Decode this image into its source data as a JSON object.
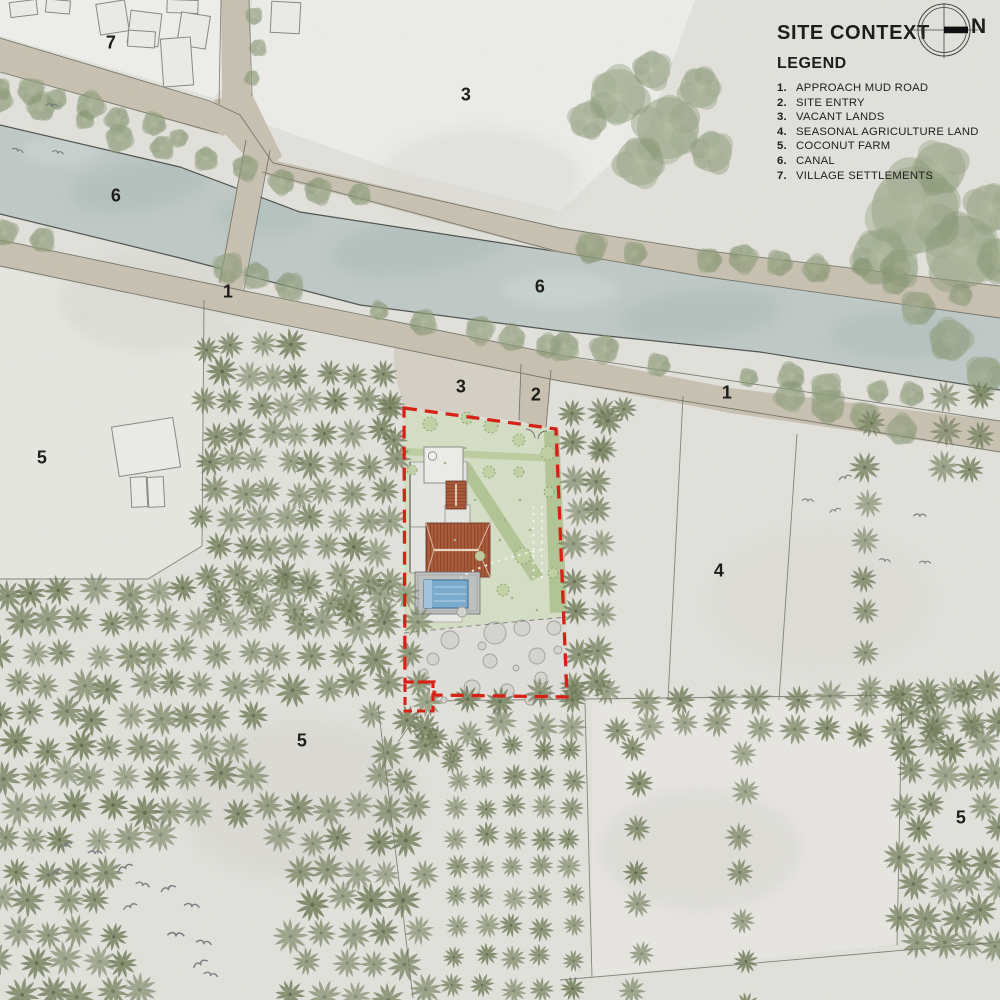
{
  "title_block": {
    "title": "SITE CONTEXT",
    "north_label": "N",
    "legend_heading": "LEGEND",
    "legend_items": [
      {
        "num": "1.",
        "label": "APPROACH MUD ROAD"
      },
      {
        "num": "2.",
        "label": "SITE ENTRY"
      },
      {
        "num": "3.",
        "label": "VACANT LANDS"
      },
      {
        "num": "4.",
        "label": "SEASONAL AGRICULTURE LAND"
      },
      {
        "num": "5.",
        "label": "COCONUT FARM"
      },
      {
        "num": "6.",
        "label": "CANAL"
      },
      {
        "num": "7.",
        "label": "VILLAGE SETTLEMENTS"
      }
    ]
  },
  "map_labels": [
    {
      "text": "7",
      "x": 111,
      "y": 43
    },
    {
      "text": "3",
      "x": 466,
      "y": 95
    },
    {
      "text": "6",
      "x": 116,
      "y": 196
    },
    {
      "text": "6",
      "x": 540,
      "y": 287
    },
    {
      "text": "1",
      "x": 228,
      "y": 292
    },
    {
      "text": "1",
      "x": 727,
      "y": 393
    },
    {
      "text": "3",
      "x": 461,
      "y": 387
    },
    {
      "text": "2",
      "x": 536,
      "y": 395
    },
    {
      "text": "5",
      "x": 42,
      "y": 458
    },
    {
      "text": "4",
      "x": 719,
      "y": 571
    },
    {
      "text": "5",
      "x": 302,
      "y": 741
    },
    {
      "text": "5",
      "x": 961,
      "y": 818
    }
  ],
  "colors": {
    "paper": "#e9e8e2",
    "white_zone": "#f4f4f0",
    "road": "#cfc8b8",
    "road_edge": "#585b51",
    "canal": "#c6d0cd",
    "canal_blotch": "#aebfbb",
    "bank_line": "#3e423d",
    "palm": "#73805c",
    "palm_inner": "#87936e",
    "tree": "#8e9c79",
    "lawn": "#dce5cc",
    "hedge": "#b9cc9c",
    "roof": "#b4603f",
    "pool": "#7fb2d6",
    "deck": "#c6c8c8",
    "boundary_red": "#df2317",
    "text": "#1d1d1a",
    "bird": "#72787c"
  },
  "vegetation": {
    "palm_grids": [
      {
        "x0": 205,
        "y0": 346,
        "x1": 398,
        "y1": 620,
        "dx": 27,
        "dy": 29,
        "stagger": 13,
        "jitter": 5,
        "smin": 0.95,
        "smax": 1.2,
        "min_line": {
          "a": 286,
          "b": 0.207
        },
        "holes": []
      },
      {
        "x0": 2,
        "y0": 592,
        "x1": 420,
        "y1": 1000,
        "dx": 31,
        "dy": 31,
        "stagger": 15,
        "jitter": 6,
        "smin": 1.0,
        "smax": 1.3,
        "holes": [
          {
            "x": 305,
            "y": 745,
            "r": 55
          },
          {
            "x": 205,
            "y": 915,
            "r": 88
          },
          {
            "x": 235,
            "y": 1000,
            "r": 60
          }
        ]
      },
      {
        "x0": 576,
        "y0": 412,
        "x1": 600,
        "y1": 700,
        "dx": 24,
        "dy": 34,
        "stagger": 0,
        "jitter": 5,
        "smin": 1.0,
        "smax": 1.2,
        "holes": []
      },
      {
        "x0": 432,
        "y0": 698,
        "x1": 1000,
        "y1": 728,
        "dx": 36,
        "dy": 30,
        "stagger": 0,
        "jitter": 7,
        "smin": 1.0,
        "smax": 1.2,
        "holes": []
      },
      {
        "x0": 455,
        "y0": 748,
        "x1": 574,
        "y1": 1000,
        "dx": 29,
        "dy": 30,
        "stagger": 0,
        "jitter": 4,
        "smin": 0.78,
        "smax": 0.95,
        "holes": []
      },
      {
        "x0": 638,
        "y0": 748,
        "x1": 652,
        "y1": 1000,
        "dx": 20,
        "dy": 40,
        "stagger": 0,
        "jitter": 6,
        "smin": 0.9,
        "smax": 1.1,
        "holes": []
      },
      {
        "x0": 744,
        "y0": 748,
        "x1": 758,
        "y1": 1000,
        "dx": 20,
        "dy": 42,
        "stagger": 0,
        "jitter": 6,
        "smin": 0.9,
        "smax": 1.1,
        "holes": []
      },
      {
        "x0": 902,
        "y0": 690,
        "x1": 1000,
        "y1": 958,
        "dx": 27,
        "dy": 28,
        "stagger": 13,
        "jitter": 5,
        "smin": 1.0,
        "smax": 1.25,
        "holes": [
          {
            "x": 960,
            "y": 818,
            "r": 22
          }
        ]
      },
      {
        "x0": 868,
        "y0": 428,
        "x1": 888,
        "y1": 700,
        "dx": 22,
        "dy": 37,
        "stagger": 0,
        "jitter": 5,
        "smin": 0.95,
        "smax": 1.15,
        "holes": []
      },
      {
        "x0": 945,
        "y0": 398,
        "x1": 1000,
        "y1": 486,
        "dx": 30,
        "dy": 34,
        "stagger": 0,
        "jitter": 6,
        "smin": 1.0,
        "smax": 1.2,
        "holes": []
      }
    ],
    "palm_singles": [
      [
        608,
        421,
        1.1
      ],
      [
        600,
        450,
        1.0
      ],
      [
        624,
        409,
        0.95
      ],
      [
        390,
        408,
        1.05
      ],
      [
        394,
        440,
        1.0
      ],
      [
        572,
        700,
        1.0
      ],
      [
        436,
        737,
        0.9
      ],
      [
        452,
        762,
        0.85
      ]
    ],
    "tree_rows": [
      {
        "pts": [
          [
            0,
            98
          ],
          [
            245,
            168
          ],
          [
            560,
            246
          ],
          [
            860,
            272
          ],
          [
            1000,
            298
          ]
        ],
        "spacing": 40,
        "r": 13,
        "skip": 0.25
      },
      {
        "pts": [
          [
            0,
            228
          ],
          [
            245,
            280
          ],
          [
            560,
            346
          ],
          [
            745,
            374
          ],
          [
            1000,
            410
          ]
        ],
        "spacing": 44,
        "r": 13,
        "skip": 0.3
      },
      {
        "pts": [
          [
            4,
            84
          ],
          [
            205,
            142
          ]
        ],
        "spacing": 30,
        "r": 12,
        "skip": 0.1
      }
    ],
    "tree_clusters": [
      [
        618,
        96,
        30
      ],
      [
        668,
        128,
        34
      ],
      [
        640,
        162,
        26
      ],
      [
        700,
        88,
        22
      ],
      [
        588,
        120,
        20
      ],
      [
        712,
        152,
        22
      ],
      [
        652,
        70,
        20
      ],
      [
        915,
        210,
        48
      ],
      [
        962,
        252,
        40
      ],
      [
        880,
        257,
        30
      ],
      [
        940,
        168,
        28
      ],
      [
        990,
        208,
        26
      ],
      [
        1000,
        260,
        24
      ],
      [
        950,
        340,
        22
      ],
      [
        985,
        375,
        20
      ],
      [
        918,
        308,
        18
      ],
      [
        900,
        268,
        20
      ],
      [
        790,
        396,
        16
      ],
      [
        828,
        406,
        18
      ],
      [
        864,
        416,
        15
      ],
      [
        902,
        430,
        16
      ],
      [
        254,
        16,
        9
      ],
      [
        258,
        48,
        9
      ],
      [
        252,
        78,
        8
      ],
      [
        228,
        268,
        16
      ],
      [
        256,
        276,
        14
      ],
      [
        480,
        330,
        15
      ],
      [
        512,
        338,
        14
      ],
      [
        548,
        346,
        13
      ]
    ]
  },
  "birds": [
    [
      52,
      105,
      1.0
    ],
    [
      18,
      150,
      0.9
    ],
    [
      58,
      152,
      0.9
    ],
    [
      845,
      477,
      1.0
    ],
    [
      808,
      500,
      0.9
    ],
    [
      835,
      510,
      0.9
    ],
    [
      920,
      515,
      1.0
    ],
    [
      925,
      562,
      0.9
    ],
    [
      885,
      560,
      0.9
    ],
    [
      65,
      845,
      1.1
    ],
    [
      95,
      852,
      1.1
    ],
    [
      57,
      872,
      1.0
    ],
    [
      125,
      867,
      1.2
    ],
    [
      143,
      884,
      1.1
    ],
    [
      168,
      888,
      1.2
    ],
    [
      130,
      906,
      1.1
    ],
    [
      192,
      905,
      1.2
    ],
    [
      176,
      934,
      1.3
    ],
    [
      204,
      942,
      1.2
    ],
    [
      200,
      963,
      1.2
    ],
    [
      211,
      974,
      1.1
    ]
  ],
  "village_buildings": [
    [
      10,
      1,
      27,
      15,
      -7
    ],
    [
      46,
      0,
      24,
      13,
      5
    ],
    [
      98,
      2,
      29,
      31,
      -9
    ],
    [
      129,
      12,
      31,
      33,
      7
    ],
    [
      167,
      0,
      31,
      13,
      2
    ],
    [
      179,
      14,
      29,
      33,
      9
    ],
    [
      128,
      31,
      27,
      16,
      4
    ],
    [
      162,
      38,
      30,
      48,
      -4
    ],
    [
      271,
      2,
      29,
      31,
      3
    ]
  ],
  "farm_sheds": [
    [
      115,
      422,
      62,
      50,
      -9
    ],
    [
      131,
      477,
      16,
      30,
      -3
    ],
    [
      148,
      477,
      16,
      30,
      -3
    ]
  ],
  "site_details": {
    "orchard_circles": [
      [
        450,
        640,
        9
      ],
      [
        495,
        633,
        11
      ],
      [
        522,
        628,
        8
      ],
      [
        537,
        656,
        8
      ],
      [
        490,
        661,
        7
      ],
      [
        433,
        659,
        6
      ],
      [
        472,
        688,
        8
      ],
      [
        507,
        691,
        7
      ],
      [
        541,
        678,
        6
      ],
      [
        554,
        628,
        7
      ],
      [
        424,
        673,
        4
      ],
      [
        482,
        646,
        4
      ],
      [
        462,
        612,
        5
      ],
      [
        530,
        700,
        5
      ],
      [
        547,
        692,
        4
      ],
      [
        444,
        700,
        3
      ],
      [
        516,
        668,
        3
      ],
      [
        558,
        650,
        4
      ]
    ],
    "lawn_shrubs": [
      [
        430,
        424,
        7
      ],
      [
        467,
        418,
        6
      ],
      [
        491,
        426,
        7
      ],
      [
        519,
        440,
        6
      ],
      [
        548,
        453,
        7
      ],
      [
        412,
        470,
        5
      ],
      [
        489,
        472,
        6
      ],
      [
        519,
        472,
        5
      ],
      [
        549,
        492,
        5
      ],
      [
        523,
        556,
        8
      ],
      [
        503,
        590,
        6
      ],
      [
        553,
        573,
        5
      ],
      [
        480,
        556,
        5
      ]
    ],
    "grass_dots": [
      [
        445,
        463
      ],
      [
        475,
        500
      ],
      [
        505,
        520
      ],
      [
        455,
        540
      ],
      [
        500,
        540
      ],
      [
        520,
        500
      ],
      [
        465,
        448
      ],
      [
        530,
        530
      ],
      [
        512,
        598
      ],
      [
        537,
        610
      ]
    ]
  },
  "plot_lines": [
    [
      [
        204,
        300
      ],
      [
        202,
        546
      ]
    ],
    [
      [
        202,
        546
      ],
      [
        148,
        579
      ]
    ],
    [
      [
        148,
        579
      ],
      [
        0,
        579
      ]
    ],
    [
      [
        683,
        396
      ],
      [
        668,
        700
      ]
    ],
    [
      [
        797,
        434
      ],
      [
        779,
        700
      ]
    ],
    [
      [
        585,
        703
      ],
      [
        592,
        977
      ]
    ],
    [
      [
        902,
        700
      ],
      [
        897,
        945
      ]
    ],
    [
      [
        378,
        705
      ],
      [
        413,
        998
      ]
    ],
    [
      [
        430,
        701
      ],
      [
        900,
        695
      ]
    ],
    [
      [
        560,
        980
      ],
      [
        975,
        944
      ],
      [
        1000,
        942
      ]
    ],
    [
      [
        420,
        711
      ],
      [
        398,
        742
      ]
    ]
  ]
}
